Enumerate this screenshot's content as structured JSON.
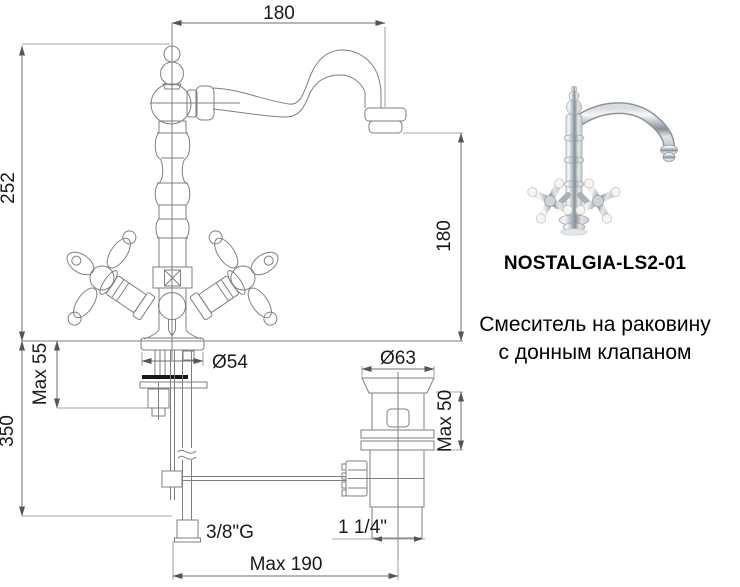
{
  "page": {
    "background": "#ffffff"
  },
  "drawing": {
    "line_color": "#7f7f7f",
    "text_color": "#1a1a1a",
    "dims": {
      "spout_reach": "180",
      "total_height": "252",
      "spout_height": "180",
      "base_diameter": "Ø54",
      "max_deck": "Max 55",
      "supply_drop": "350",
      "supply_thread": "3/8\"G",
      "max_reach": "Max 190",
      "drain_flange": "Ø63",
      "drain_max_deck": "Max 50",
      "drain_thread": "1 1/4\""
    }
  },
  "product": {
    "model": "NOSTALGIA-LS2-01",
    "description_line1": "Смеситель на раковину",
    "description_line2": "с донным клапаном"
  }
}
